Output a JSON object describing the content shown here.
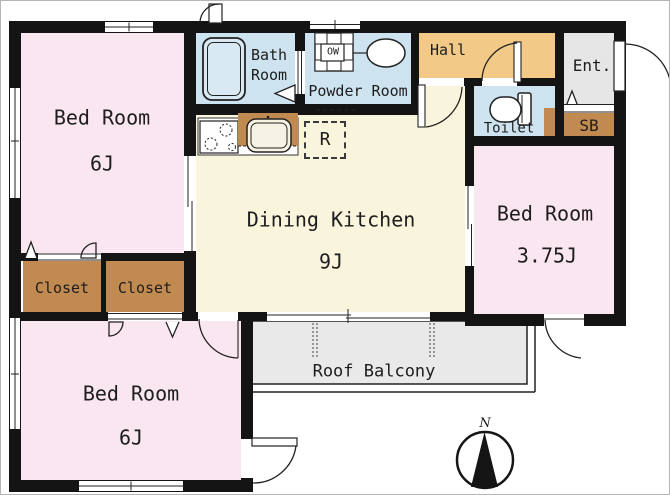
{
  "plan_title": "apartment-floor-plan",
  "colors": {
    "wall": "#141414",
    "bedroom_pink": "#FAE6F0",
    "kitchen_cream": "#F8F5DC",
    "wet_area_blue": "#CDE3F0",
    "hall_orange": "#F2C987",
    "entrance_gray": "#E6E6E6",
    "storage_brown": "#C18A50",
    "balcony_gray": "#E9E9E9"
  },
  "rooms": {
    "bedroom_top": {
      "label": "Bed Room",
      "size": "6J"
    },
    "bedroom_bottom": {
      "label": "Bed Room",
      "size": "6J"
    },
    "bedroom_right": {
      "label": "Bed Room",
      "size": "3.75J"
    },
    "dining_kitchen": {
      "label": "Dining Kitchen",
      "size": "9J"
    },
    "bath": {
      "label": "Bath\nRoom"
    },
    "powder_room": {
      "label": "Powder Room"
    },
    "hall": {
      "label": "Hall"
    },
    "entrance": {
      "label": "Ent."
    },
    "toilet": {
      "label": "Toilet"
    },
    "shoe_box": {
      "label": "SB"
    },
    "closet_left": {
      "label": "Closet"
    },
    "closet_right": {
      "label": "Closet"
    },
    "roof_balcony": {
      "label": "Roof Balcony"
    },
    "refrigerator_space": {
      "label": "R"
    },
    "washing_machine": {
      "label": "OW"
    }
  },
  "compass": {
    "north": "N"
  }
}
